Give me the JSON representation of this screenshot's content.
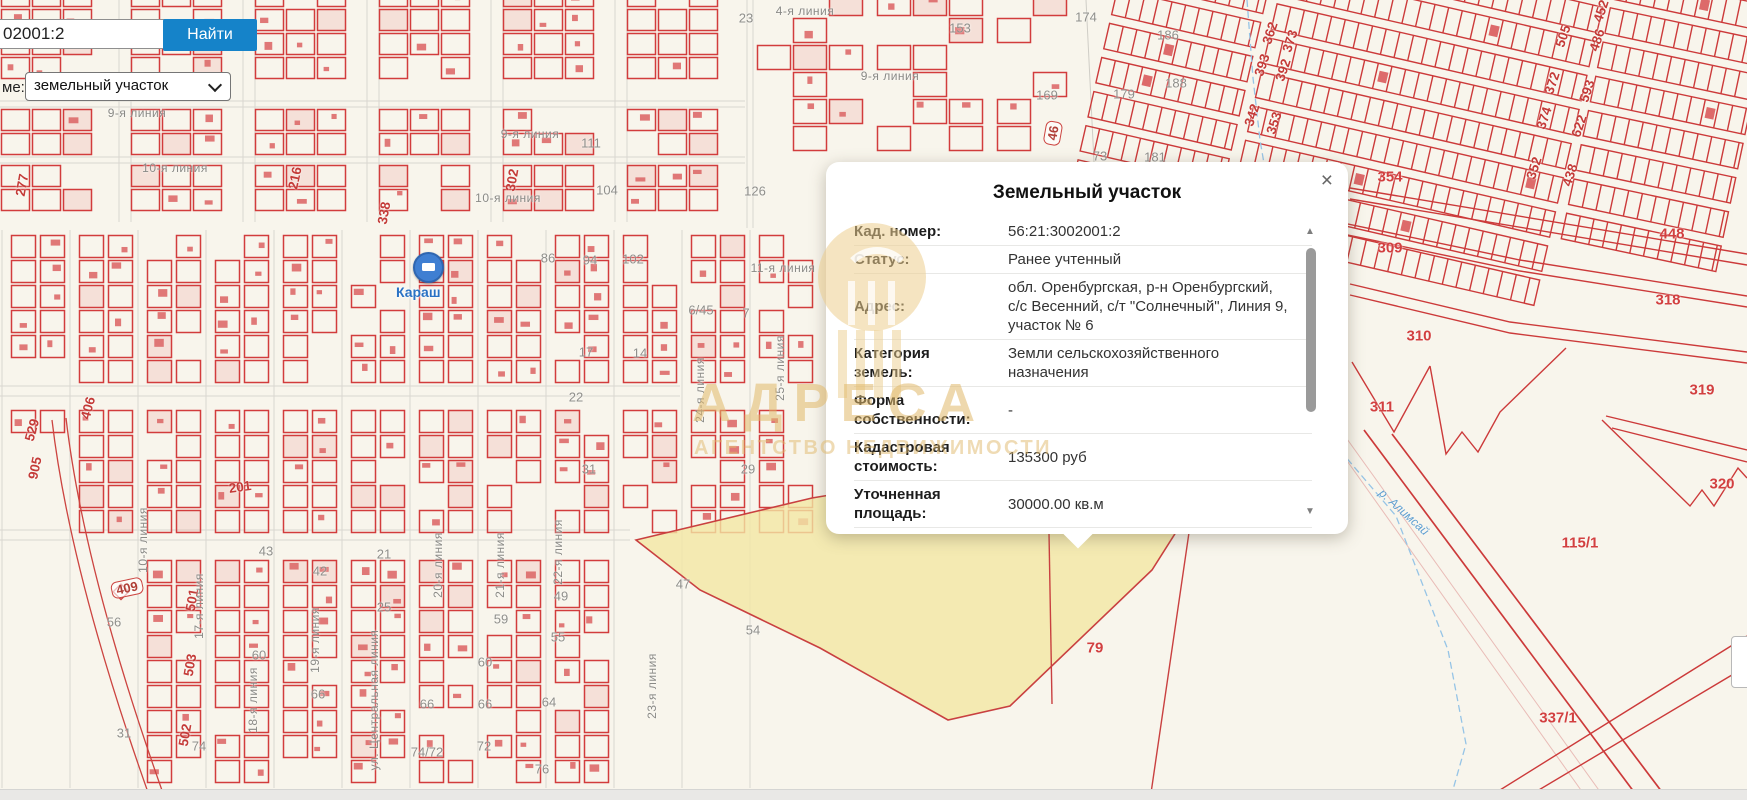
{
  "search": {
    "query": "02001:2",
    "button_label": "Найти",
    "layer_label": "ме:",
    "layer_value": "земельный участок"
  },
  "popup": {
    "title": "Земельный участок",
    "close_label": "×",
    "rows": [
      {
        "label": "Кад. номер:",
        "value": "56:21:3002001:2"
      },
      {
        "label": "Статус:",
        "value": "Ранее учтенный"
      },
      {
        "label": "Адрес:",
        "value": "обл. Оренбургская, р-н Оренбургский, с/с Весенний, с/т \"Солнечный\", Линия 9, участок № 6"
      },
      {
        "label": "Категория земель:",
        "value": "Земли сельскохозяйственного назначения"
      },
      {
        "label": "Форма собственности:",
        "value": "-"
      },
      {
        "label": "Кадастровая стоимость:",
        "value": "135300 руб"
      },
      {
        "label": "Уточненная площадь:",
        "value": "30000.00 кв.м"
      },
      {
        "label": "Разрешенное",
        "value": ""
      }
    ]
  },
  "watermark": {
    "title": "АДРЕСА",
    "subtitle": "АГЕНТСТВО НЕДВИЖИМОСТИ"
  },
  "map": {
    "marker_label": "Караш",
    "labels": [
      {
        "t": "23",
        "x": 746,
        "y": 18,
        "c": "gn"
      },
      {
        "t": "174",
        "x": 1086,
        "y": 17,
        "c": "gn"
      },
      {
        "t": "153",
        "x": 960,
        "y": 28,
        "c": "gn"
      },
      {
        "t": "186",
        "x": 1168,
        "y": 35,
        "c": "gn"
      },
      {
        "t": "169",
        "x": 1047,
        "y": 95,
        "c": "gn"
      },
      {
        "t": "179",
        "x": 1124,
        "y": 94,
        "c": "gn"
      },
      {
        "t": "188",
        "x": 1176,
        "y": 83,
        "c": "gn"
      },
      {
        "t": "126",
        "x": 755,
        "y": 191,
        "c": "gn"
      },
      {
        "t": "111",
        "x": 591,
        "y": 143,
        "c": "gn"
      },
      {
        "t": "104",
        "x": 607,
        "y": 190,
        "c": "gn"
      },
      {
        "t": "102",
        "x": 633,
        "y": 259,
        "c": "gn"
      },
      {
        "t": "94",
        "x": 590,
        "y": 260,
        "c": "gn"
      },
      {
        "t": "86",
        "x": 548,
        "y": 258,
        "c": "gn"
      },
      {
        "t": "73",
        "x": 1100,
        "y": 156,
        "c": "gn"
      },
      {
        "t": "181",
        "x": 1155,
        "y": 157,
        "c": "gn"
      },
      {
        "t": "6/45",
        "x": 701,
        "y": 310,
        "c": "gn"
      },
      {
        "t": "7",
        "x": 746,
        "y": 313,
        "c": "gn"
      },
      {
        "t": "17",
        "x": 586,
        "y": 352,
        "c": "gn"
      },
      {
        "t": "14",
        "x": 640,
        "y": 353,
        "c": "gn"
      },
      {
        "t": "22",
        "x": 576,
        "y": 397,
        "c": "gn"
      },
      {
        "t": "31",
        "x": 589,
        "y": 469,
        "c": "gn"
      },
      {
        "t": "29",
        "x": 748,
        "y": 469,
        "c": "gn"
      },
      {
        "t": "47",
        "x": 683,
        "y": 584,
        "c": "gn"
      },
      {
        "t": "54",
        "x": 753,
        "y": 630,
        "c": "gn"
      },
      {
        "t": "43",
        "x": 266,
        "y": 551,
        "c": "gn"
      },
      {
        "t": "42",
        "x": 320,
        "y": 571,
        "c": "gn"
      },
      {
        "t": "21",
        "x": 384,
        "y": 554,
        "c": "gn"
      },
      {
        "t": "25",
        "x": 384,
        "y": 607,
        "c": "gn"
      },
      {
        "t": "49",
        "x": 561,
        "y": 596,
        "c": "gn"
      },
      {
        "t": "56",
        "x": 114,
        "y": 622,
        "c": "gn"
      },
      {
        "t": "60",
        "x": 259,
        "y": 655,
        "c": "gn"
      },
      {
        "t": "66",
        "x": 318,
        "y": 694,
        "c": "gn"
      },
      {
        "t": "74",
        "x": 199,
        "y": 746,
        "c": "gn"
      },
      {
        "t": "74/72",
        "x": 427,
        "y": 752,
        "c": "gn"
      },
      {
        "t": "72",
        "x": 484,
        "y": 746,
        "c": "gn"
      },
      {
        "t": "76",
        "x": 542,
        "y": 769,
        "c": "gn"
      },
      {
        "t": "64",
        "x": 549,
        "y": 702,
        "c": "gn"
      },
      {
        "t": "59",
        "x": 501,
        "y": 619,
        "c": "gn"
      },
      {
        "t": "55",
        "x": 558,
        "y": 637,
        "c": "gn"
      },
      {
        "t": "60",
        "x": 485,
        "y": 662,
        "c": "gn"
      },
      {
        "t": "66",
        "x": 427,
        "y": 704,
        "c": "gn"
      },
      {
        "t": "66",
        "x": 485,
        "y": 704,
        "c": "gn"
      },
      {
        "t": "31",
        "x": 124,
        "y": 733,
        "c": "gn"
      },
      {
        "t": "216",
        "x": 295,
        "y": 178,
        "c": "rn",
        "r": -78
      },
      {
        "t": "302",
        "x": 512,
        "y": 180,
        "c": "rn",
        "r": -80
      },
      {
        "t": "338",
        "x": 384,
        "y": 213,
        "c": "rn",
        "r": -80
      },
      {
        "t": "277",
        "x": 22,
        "y": 185,
        "c": "rn",
        "r": -80
      },
      {
        "t": "501",
        "x": 192,
        "y": 600,
        "c": "rn",
        "r": -80
      },
      {
        "t": "503",
        "x": 190,
        "y": 665,
        "c": "rn",
        "r": -80
      },
      {
        "t": "502",
        "x": 185,
        "y": 735,
        "c": "rn",
        "r": -80
      },
      {
        "t": "529",
        "x": 32,
        "y": 430,
        "c": "rn",
        "r": -75
      },
      {
        "t": "406",
        "x": 88,
        "y": 408,
        "c": "rn",
        "r": -75
      },
      {
        "t": "905",
        "x": 35,
        "y": 468,
        "c": "rn",
        "r": -78
      },
      {
        "t": "201",
        "x": 240,
        "y": 487,
        "c": "rn",
        "r": -8
      },
      {
        "t": "362",
        "x": 1270,
        "y": 33,
        "c": "rn",
        "r": -72
      },
      {
        "t": "373",
        "x": 1290,
        "y": 41,
        "c": "rn",
        "r": -72
      },
      {
        "t": "393",
        "x": 1262,
        "y": 65,
        "c": "rn",
        "r": -72
      },
      {
        "t": "392",
        "x": 1283,
        "y": 70,
        "c": "rn",
        "r": -72
      },
      {
        "t": "342",
        "x": 1252,
        "y": 115,
        "c": "rn",
        "r": -72
      },
      {
        "t": "353",
        "x": 1274,
        "y": 123,
        "c": "rn",
        "r": -72
      },
      {
        "t": "505",
        "x": 1563,
        "y": 36,
        "c": "rn",
        "r": -72
      },
      {
        "t": "486",
        "x": 1597,
        "y": 40,
        "c": "rn",
        "r": -72
      },
      {
        "t": "452",
        "x": 1601,
        "y": 11,
        "c": "rn",
        "r": -72
      },
      {
        "t": "372",
        "x": 1552,
        "y": 83,
        "c": "rn",
        "r": -72
      },
      {
        "t": "593",
        "x": 1587,
        "y": 91,
        "c": "rn",
        "r": -72
      },
      {
        "t": "374",
        "x": 1544,
        "y": 118,
        "c": "rn",
        "r": -72
      },
      {
        "t": "622",
        "x": 1579,
        "y": 126,
        "c": "rn",
        "r": -72
      },
      {
        "t": "352",
        "x": 1534,
        "y": 168,
        "c": "rn",
        "r": -72
      },
      {
        "t": "438",
        "x": 1570,
        "y": 175,
        "c": "rn",
        "r": -72
      },
      {
        "t": "354",
        "x": 1390,
        "y": 177,
        "c": "rr"
      },
      {
        "t": "309",
        "x": 1390,
        "y": 248,
        "c": "rr"
      },
      {
        "t": "448",
        "x": 1672,
        "y": 234,
        "c": "rr"
      },
      {
        "t": "318",
        "x": 1668,
        "y": 300,
        "c": "rr"
      },
      {
        "t": "310",
        "x": 1419,
        "y": 336,
        "c": "rr"
      },
      {
        "t": "319",
        "x": 1702,
        "y": 390,
        "c": "rr"
      },
      {
        "t": "311",
        "x": 1382,
        "y": 407,
        "c": "rr"
      },
      {
        "t": "320",
        "x": 1722,
        "y": 484,
        "c": "rr"
      },
      {
        "t": "115/1",
        "x": 1580,
        "y": 543,
        "c": "rr"
      },
      {
        "t": "79",
        "x": 1095,
        "y": 648,
        "c": "rr"
      },
      {
        "t": "337/1",
        "x": 1558,
        "y": 718,
        "c": "rr"
      },
      {
        "t": "409",
        "x": 127,
        "y": 588,
        "c": "rb",
        "r": -12
      },
      {
        "t": "46",
        "x": 1053,
        "y": 133,
        "c": "rb",
        "r": -80
      },
      {
        "t": "9-я линия",
        "x": 137,
        "y": 113,
        "c": "st"
      },
      {
        "t": "10-я линия",
        "x": 175,
        "y": 168,
        "c": "st"
      },
      {
        "t": "9-я линия",
        "x": 530,
        "y": 134,
        "c": "st"
      },
      {
        "t": "10-я линия",
        "x": 508,
        "y": 198,
        "c": "st"
      },
      {
        "t": "11-я линия",
        "x": 783,
        "y": 268,
        "c": "st"
      },
      {
        "t": "9-я линия",
        "x": 890,
        "y": 76,
        "c": "st"
      },
      {
        "t": "4-я линия",
        "x": 805,
        "y": 11,
        "c": "st"
      },
      {
        "t": "17-я линия",
        "x": 199,
        "y": 606,
        "c": "sv",
        "r": -90
      },
      {
        "t": "18-я линия",
        "x": 253,
        "y": 700,
        "c": "sv",
        "r": -90
      },
      {
        "t": "19-я линия",
        "x": 315,
        "y": 640,
        "c": "sv",
        "r": -90
      },
      {
        "t": "ул. Центральная линия",
        "x": 374,
        "y": 700,
        "c": "sv",
        "r": -90
      },
      {
        "t": "20-я линия",
        "x": 438,
        "y": 565,
        "c": "sv",
        "r": -90
      },
      {
        "t": "21-я линия",
        "x": 500,
        "y": 565,
        "c": "sv",
        "r": -90
      },
      {
        "t": "22-я линия",
        "x": 558,
        "y": 552,
        "c": "sv",
        "r": -90
      },
      {
        "t": "23-я линия",
        "x": 652,
        "y": 686,
        "c": "sv",
        "r": -90
      },
      {
        "t": "24-я линия",
        "x": 700,
        "y": 390,
        "c": "sv",
        "r": -90
      },
      {
        "t": "25-я линия",
        "x": 780,
        "y": 368,
        "c": "sv",
        "r": -90
      },
      {
        "t": "10-я линия",
        "x": 143,
        "y": 540,
        "c": "sv",
        "r": -90
      },
      {
        "t": "р. Алимсай",
        "x": 1404,
        "y": 512,
        "c": "bl",
        "r": 42
      }
    ]
  },
  "colors": {
    "parcel_red": "#d23c3c",
    "building_red": "#dd6a6a",
    "highlight_yellow": "rgba(243,231,164,0.8)",
    "button_blue": "#1583c9",
    "watermark_gold": "#e0b86a",
    "map_background": "#f8f5ec"
  }
}
